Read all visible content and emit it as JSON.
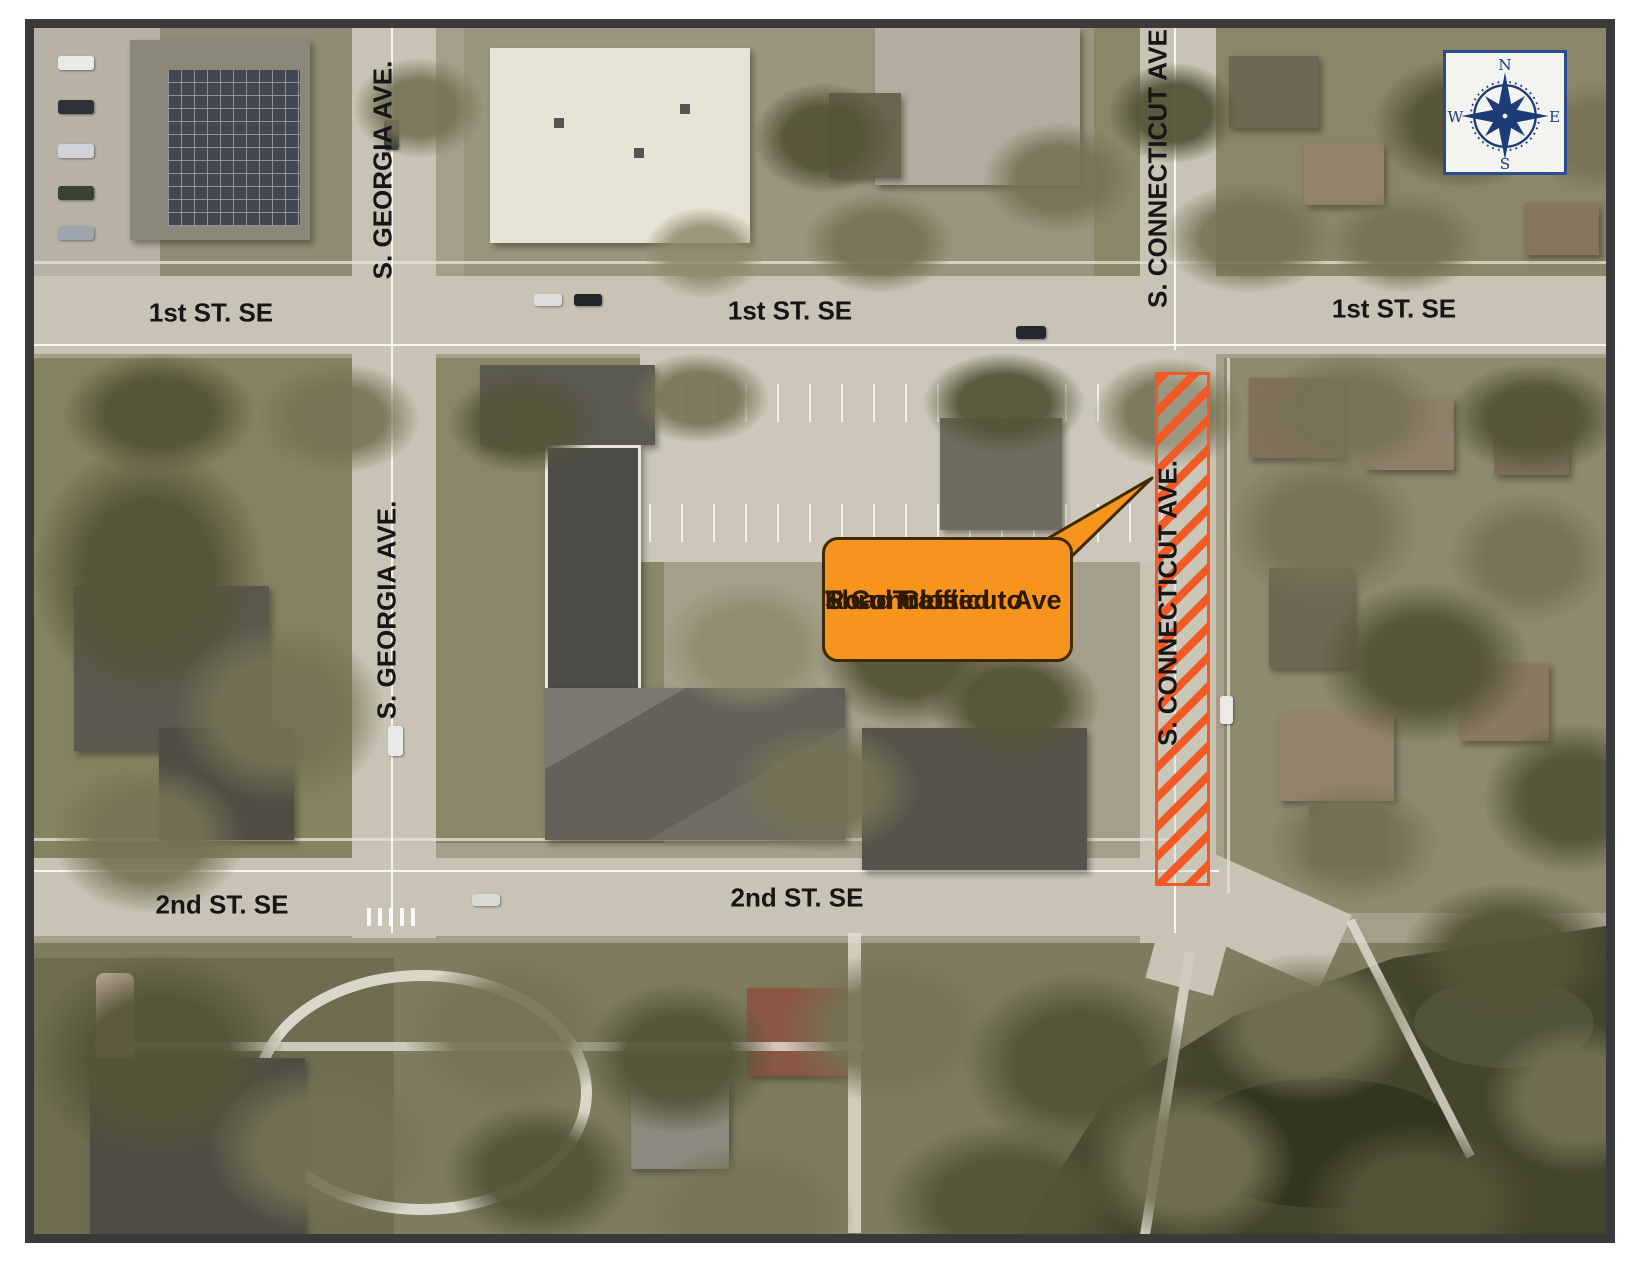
{
  "page": {
    "background": "#FFFFFF",
    "frame_color": "#3A3A3C"
  },
  "map": {
    "type": "aerial-roadmap",
    "street_labels": {
      "first_st_se": "1st ST. SE",
      "second_st_se": "2nd ST. SE",
      "s_georgia_ave": "S. GEORGIA AVE.",
      "s_connecticut_ave": "S. CONNECTICUT AVE."
    },
    "callout": {
      "line1": "S Connecticut Ave",
      "line2": "Road Closed to",
      "line3": "Thru Traffic",
      "fill": "#F7941E",
      "border_color": "#3F2A00",
      "text_color": "#2D1A00"
    },
    "road_closure": {
      "stripe_color": "#F15A24"
    },
    "compass": {
      "n": "N",
      "e": "E",
      "s": "S",
      "w": "W",
      "color": "#1E3C78"
    }
  }
}
